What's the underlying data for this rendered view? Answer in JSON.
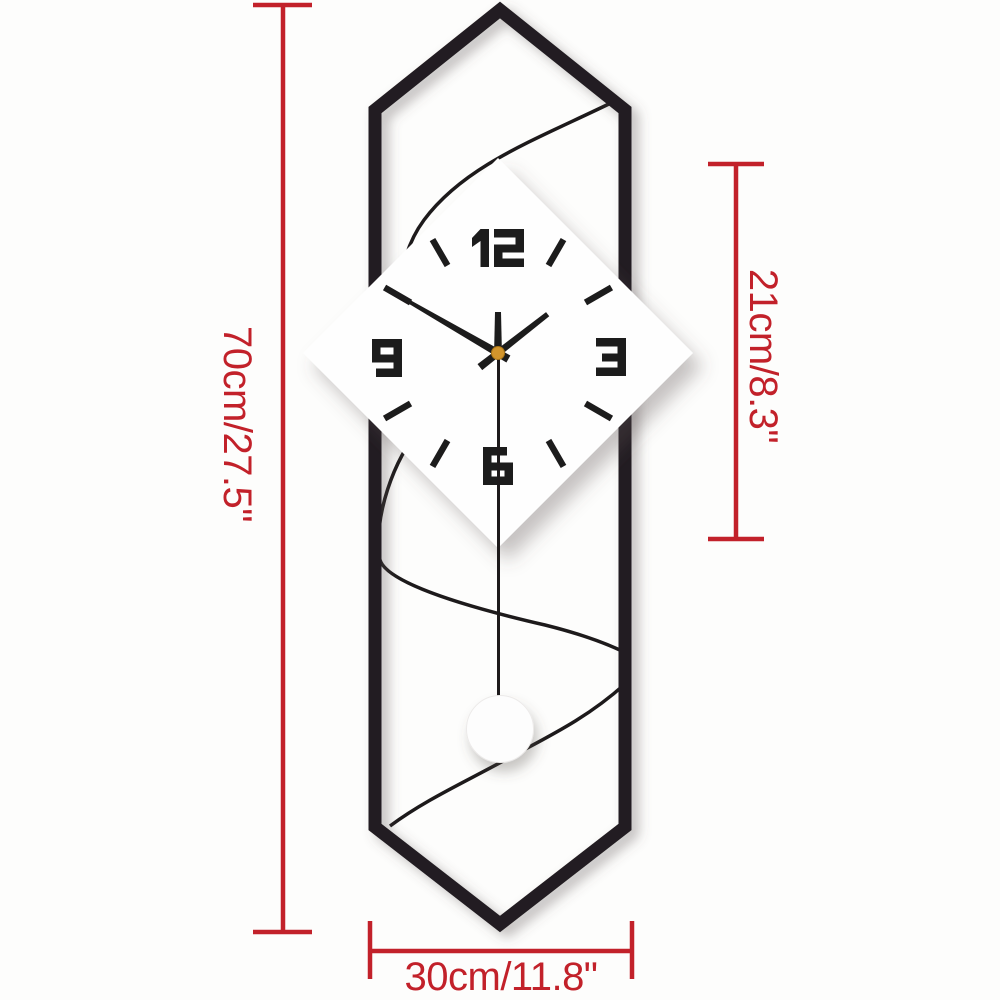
{
  "image": {
    "description": "Product dimension diagram of a geometric pendulum wall clock",
    "background_color": "#fdfdfc"
  },
  "dimensions": {
    "color": "#c2212a",
    "height": {
      "label": "70cm/27.5\""
    },
    "face": {
      "label": "21cm/8.3\""
    },
    "width": {
      "label": "30cm/11.8\""
    }
  },
  "clock": {
    "frame_color": "#221f20",
    "ink_color": "#1d1a1b",
    "face_color": "#fefefe",
    "numerals": [
      "12",
      "3",
      "6",
      "9"
    ],
    "tick_angles_deg": [
      30,
      60,
      120,
      150,
      210,
      240,
      300,
      330
    ],
    "hands": {
      "hour_angle_deg": 52,
      "minute_angle_deg": 300,
      "second_angle_deg": 0
    },
    "center_cap_color": "#d2952c",
    "pendulum_bob_color": "#fdfdfd"
  }
}
